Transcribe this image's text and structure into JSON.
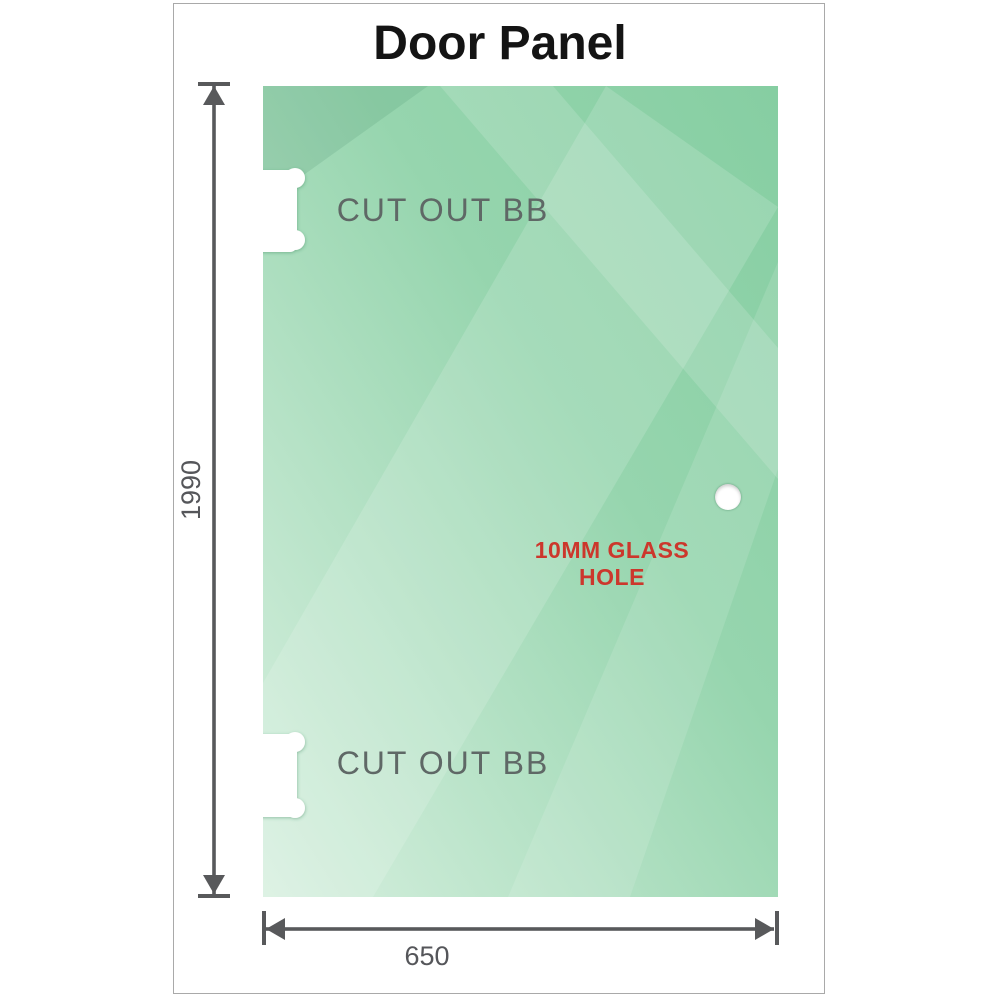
{
  "title": "Door Panel",
  "panel": {
    "cutouts": [
      {
        "label": "CUT OUT BB"
      },
      {
        "label": "CUT OUT BB"
      }
    ],
    "hole_label": "10MM GLASS HOLE"
  },
  "dimensions": {
    "height": "1990",
    "width": "650"
  },
  "colors": {
    "glass_green_dark": "#86CEA2",
    "glass_green_light": "#D8F0E0",
    "frame_border": "#A9A9A9",
    "dimension_gray": "#58595B",
    "cutout_text_gray": "#5F6866",
    "hole_text_red": "#CC372C",
    "title_black": "#141414"
  }
}
